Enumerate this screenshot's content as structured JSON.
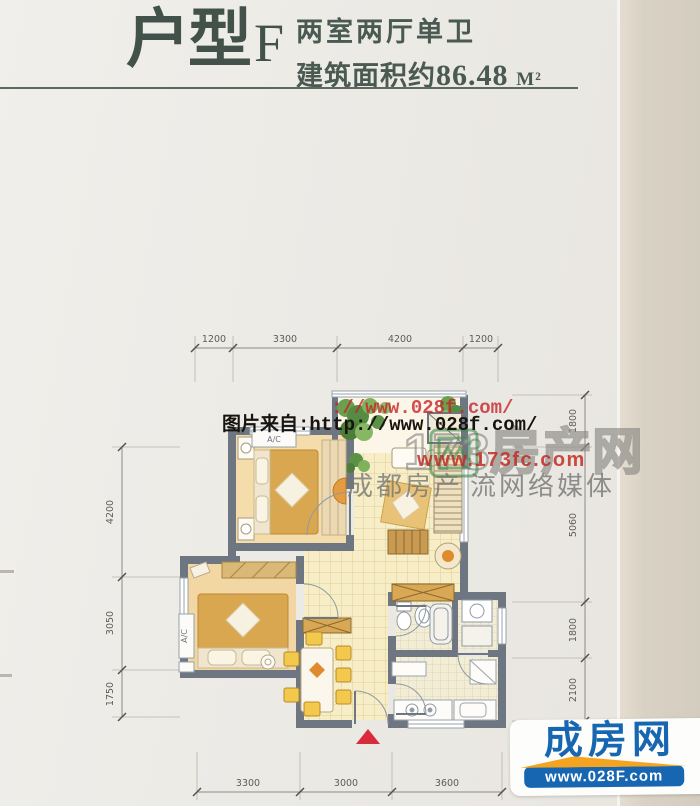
{
  "header": {
    "unit_label": "户型",
    "unit_letter": "F",
    "subtitle": "两室两厅单卫",
    "area_prefix": "建筑面积约",
    "area_value": "86.48",
    "area_unit": "M²"
  },
  "dimensions": {
    "top": [
      "1200",
      "3300",
      "4200",
      "1200"
    ],
    "left": [
      "4200",
      "3050",
      "1750"
    ],
    "right": [
      "1800",
      "5060",
      "1800",
      "2100"
    ],
    "bottom": [
      "3300",
      "3000",
      "3600"
    ]
  },
  "plan_labels": {
    "ac_top": "A/C",
    "ac_left": "A/C"
  },
  "watermarks": {
    "source_url_black": "图片来自:http://www.028f.com/",
    "source_url_red": "://www.028f.com/",
    "portal_name": "173房产网",
    "portal_url": "www.173fc.com",
    "tagline_left": "成都房产",
    "tagline_right": "流网络媒体"
  },
  "logo": {
    "brand": "成房网",
    "url": "www.028F.com"
  },
  "colors": {
    "title_text": "#42524b",
    "wall": "#6d7681",
    "tile_floor": "#f7eec8",
    "bedroom_floor": "#f4dcab",
    "bed": "#daa751",
    "accent_red": "#d92b3c",
    "logo_blue": "#1766b2",
    "logo_orange": "#f5a41f",
    "plant_green": "#5c9246"
  }
}
